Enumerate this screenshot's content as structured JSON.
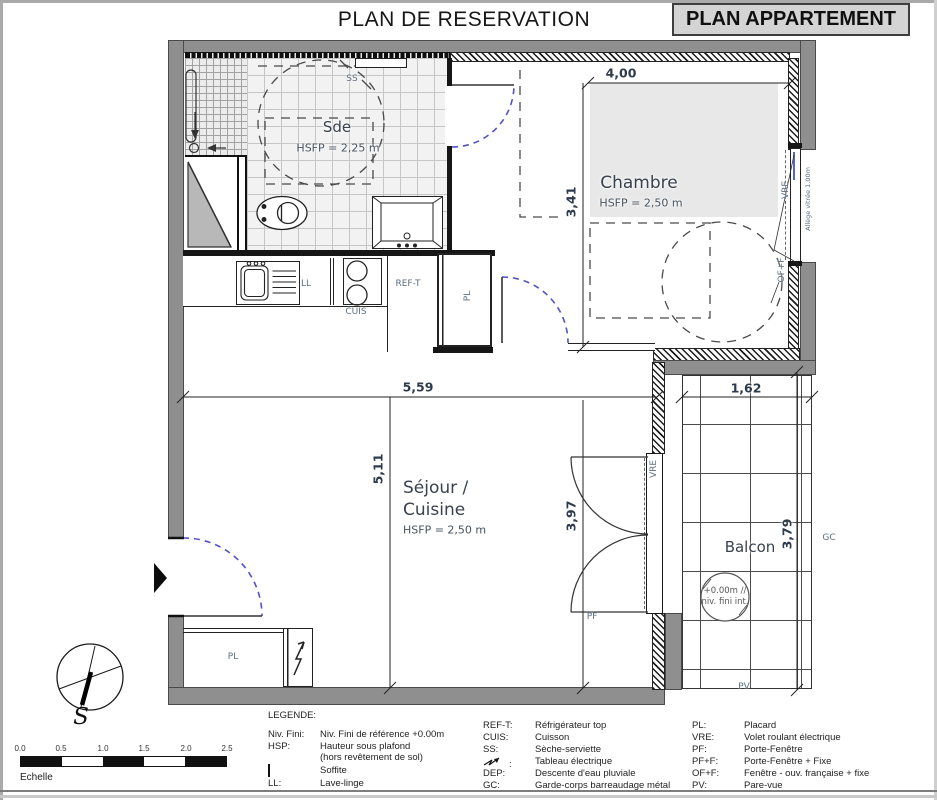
{
  "title": "PLAN DE RESERVATION",
  "title_box": "PLAN APPARTEMENT",
  "colors": {
    "wall_gray": "#8f8f8f",
    "chambre_zone": "#e8e8e8",
    "door_arc_blue": "#5151c8",
    "title_box_bg": "#d4d4d4",
    "label_blue_gray": "#5d6e80"
  },
  "rooms": {
    "sde": {
      "name": "Sde",
      "hsfp": "HSFP = 2,25 m"
    },
    "chambre": {
      "name": "Chambre",
      "hsfp": "HSFP = 2,50 m"
    },
    "sejour": {
      "name_line1": "Séjour /",
      "name_line2": "Cuisine",
      "hsfp": "HSFP = 2,50 m"
    },
    "balcon": {
      "name": "Balcon"
    }
  },
  "dimensions": {
    "chambre_width": "4,00",
    "chambre_height": "3,41",
    "sejour_width": "5,59",
    "sejour_height": "5,11",
    "pf_height": "3,97",
    "balcon_width": "1,62",
    "balcon_height": "3,79"
  },
  "labels": {
    "ss": "SS",
    "ll": "LL",
    "cuis": "CUIS",
    "ref_t": "REF-T",
    "pl": "PL",
    "vre": "VRE",
    "pf": "PF",
    "gc": "GC",
    "pv": "PV",
    "of_f": "OF+F",
    "allege": "Allège vitrée 1.00m",
    "level_line1": "+0.00m //",
    "level_line2": "niv. fini int."
  },
  "compass": {
    "south": "S"
  },
  "scale": {
    "ticks": [
      "0.0",
      "0.5",
      "1.0",
      "1.5",
      "2.0",
      "2.5"
    ],
    "label": "Echelle"
  },
  "legend": {
    "title": "LEGENDE:",
    "col1": [
      {
        "abbr": "Niv. Fini:",
        "desc": "Niv. Fini de référence +0.00m"
      },
      {
        "abbr": "HSP:",
        "desc": "Hauteur sous plafond"
      },
      {
        "abbr": "",
        "desc": "(hors revêtement de sol)"
      },
      {
        "abbr": "",
        "symbol": "soffite",
        "desc": "Soffite"
      },
      {
        "abbr": "LL:",
        "desc": "Lave-linge"
      }
    ],
    "col2": [
      {
        "abbr": "REF-T:",
        "desc": "Réfrigérateur top"
      },
      {
        "abbr": "CUIS:",
        "desc": "Cuisson"
      },
      {
        "abbr": "SS:",
        "desc": "Sèche-serviette"
      },
      {
        "abbr": ":",
        "symbol": "tableau-electrique",
        "desc": "Tableau électrique"
      },
      {
        "abbr": "DEP:",
        "desc": "Descente d'eau pluviale"
      },
      {
        "abbr": "GC:",
        "desc": "Garde-corps barreaudage métal"
      }
    ],
    "col3": [
      {
        "abbr": "PL:",
        "desc": "Placard"
      },
      {
        "abbr": "VRE:",
        "desc": "Volet roulant électrique"
      },
      {
        "abbr": "PF:",
        "desc": "Porte-Fenêtre"
      },
      {
        "abbr": "PF+F:",
        "desc": "Porte-Fenêtre + Fixe"
      },
      {
        "abbr": "OF+F:",
        "desc": "Fenêtre - ouv. française + fixe"
      },
      {
        "abbr": "PV:",
        "desc": "Pare-vue"
      }
    ]
  }
}
